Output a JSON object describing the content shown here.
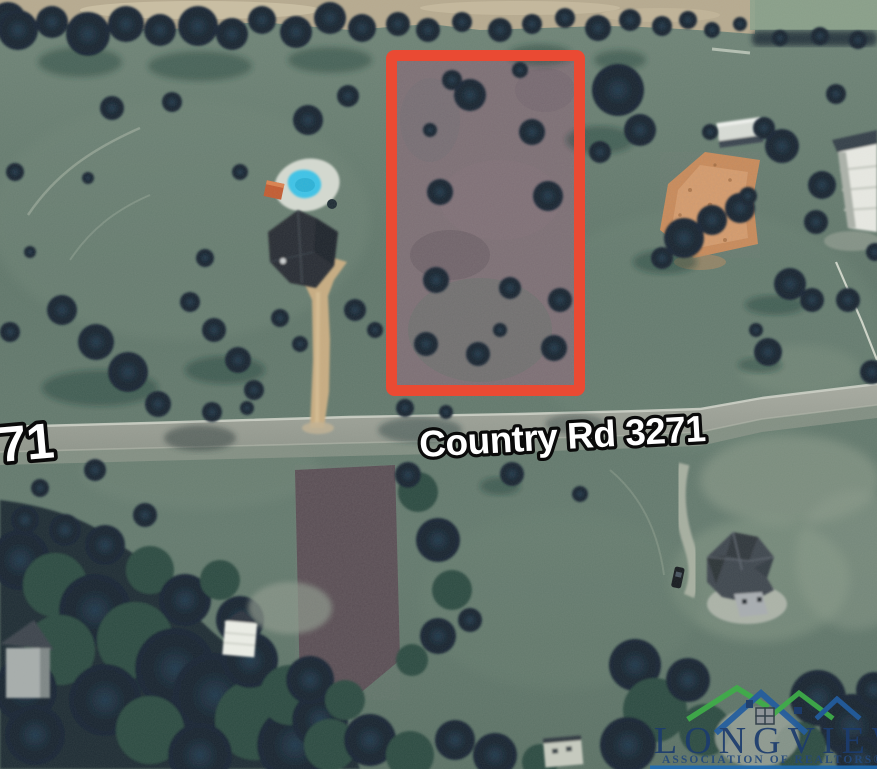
{
  "image": {
    "type": "satellite-aerial-listing-photo",
    "description": "Aerial satellite view of a rural land parcel outlined in red beside Country Rd 3271"
  },
  "labels": {
    "road_name": "Country Rd 3271",
    "road_name_partial_left": "71"
  },
  "parcel": {
    "outline_color": "#ea4a33"
  },
  "logo": {
    "title": "LONGVIEW",
    "subtitle": "ASSOCIATION OF REALTORS®",
    "title_color": "#1c3c6e",
    "roof_green": "#3fae49",
    "roof_blue": "#235d9f",
    "underline_color": "#1e6cb5"
  }
}
